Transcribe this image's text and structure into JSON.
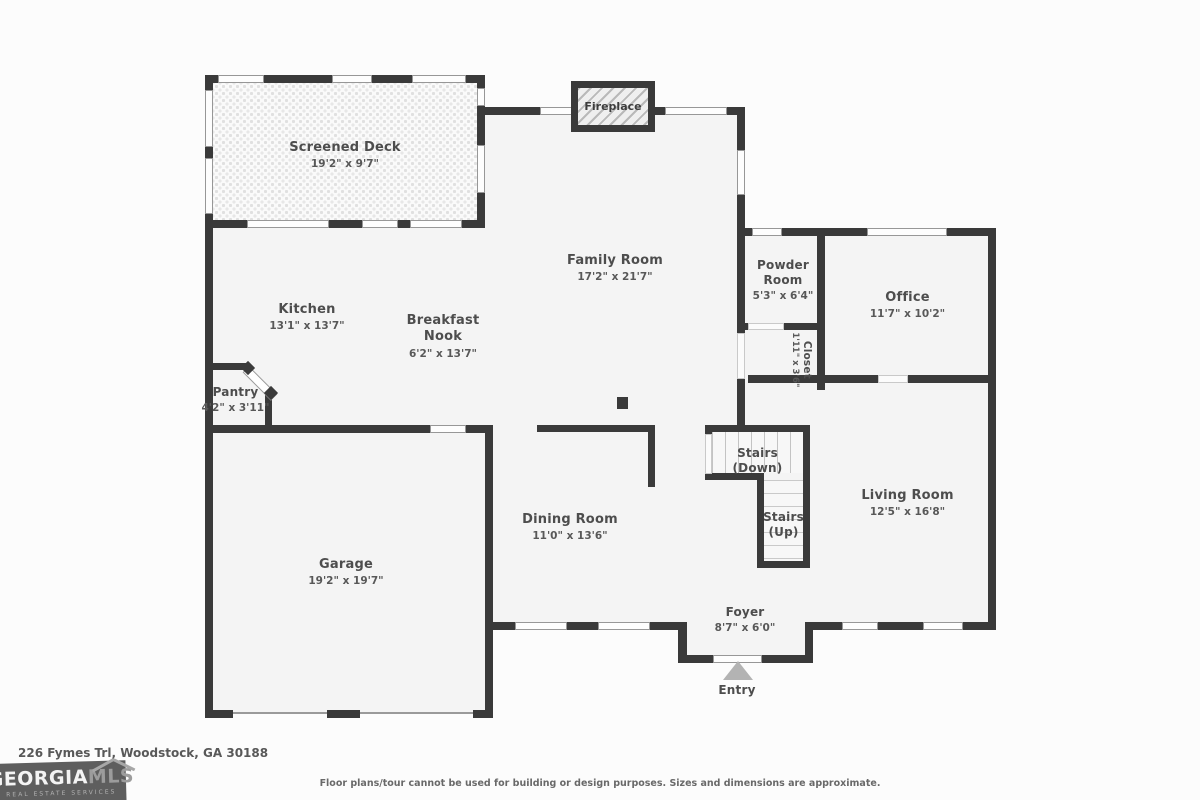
{
  "colors": {
    "wall": "#3a3a3a",
    "floor": "#f4f4f4",
    "background": "#fcfcfc",
    "label_text": "#4d4d4d",
    "entry_arrow": "#b3b3b3"
  },
  "rooms": {
    "screened_deck": {
      "name": "Screened Deck",
      "dims": "19'2\" x 9'7\""
    },
    "fireplace": {
      "name": "Fireplace"
    },
    "family_room": {
      "name": "Family Room",
      "dims": "17'2\" x 21'7\""
    },
    "powder_room": {
      "name": "Powder Room",
      "dims": "5'3\" x 6'4\""
    },
    "office": {
      "name": "Office",
      "dims": "11'7\" x 10'2\""
    },
    "closet": {
      "name": "Closet",
      "dims": "1'11\" x 3'6\""
    },
    "kitchen": {
      "name": "Kitchen",
      "dims": "13'1\" x 13'7\""
    },
    "breakfast_nook": {
      "name": "Breakfast Nook",
      "dims": "6'2\" x 13'7\""
    },
    "pantry": {
      "name": "Pantry",
      "dims": "4'2\" x 3'11\""
    },
    "stairs_down": {
      "name": "Stairs (Down)"
    },
    "stairs_up": {
      "name": "Stairs (Up)"
    },
    "dining_room": {
      "name": "Dining Room",
      "dims": "11'0\" x 13'6\""
    },
    "living_room": {
      "name": "Living Room",
      "dims": "12'5\" x 16'8\""
    },
    "garage": {
      "name": "Garage",
      "dims": "19'2\" x 19'7\""
    },
    "foyer": {
      "name": "Foyer",
      "dims": "8'7\" x 6'0\""
    },
    "entry": {
      "name": "Entry"
    }
  },
  "footer": {
    "address": "226 Fymes Trl, Woodstock, GA 30188",
    "disclaimer": "Floor plans/tour cannot be used for building or design purposes. Sizes and dimensions are approximate.",
    "logo": {
      "brand_primary": "GEORGIA",
      "brand_secondary": "MLS",
      "tagline": "REAL ESTATE SERVICES"
    }
  }
}
